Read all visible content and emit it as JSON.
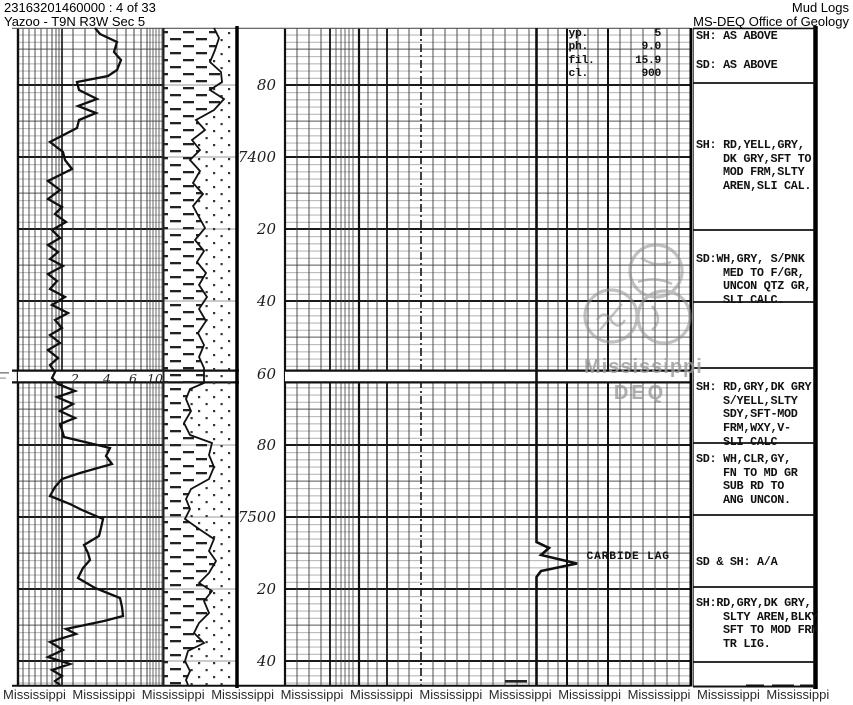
{
  "header": {
    "doc_id": "23163201460000 : 4 of 33",
    "location": "Yazoo - T9N R3W Sec 5",
    "title": "Mud Logs",
    "office": "MS-DEQ Office of Geology"
  },
  "depth_track": {
    "labels": [
      "80",
      "7400",
      "20",
      "40",
      "60",
      "80",
      "7500",
      "20",
      "40"
    ]
  },
  "rate_scale": [
    "2",
    "4",
    "6",
    "10"
  ],
  "mud_params": {
    "rows": [
      {
        "label": "yp.",
        "value": "5"
      },
      {
        "label": "ph.",
        "value": "9.0"
      },
      {
        "label": "fil.",
        "value": "15.9"
      },
      {
        "label": "cl.",
        "value": "900"
      }
    ]
  },
  "annotations": {
    "carbide": "CARBIDE LAG"
  },
  "descriptions": [
    {
      "lines": [
        "SH: AS ABOVE"
      ]
    },
    {
      "lines": [
        "SD: AS ABOVE"
      ]
    },
    {
      "lines": [
        "SH: RD,YELL,GRY,",
        "DK GRY,SFT TO",
        "MOD FRM,SLTY",
        "AREN,SLI CAL."
      ]
    },
    {
      "lines": [
        "SD:WH,GRY, S/PNK",
        "MED TO F/GR,",
        "UNCON QTZ GR,",
        "SLI CALC."
      ]
    },
    {
      "lines": [
        "SH: RD,GRY,DK GRY",
        "S/YELL,SLTY",
        "SDY,SFT-MOD",
        "FRM,WXY,V-",
        "SLI CALC"
      ]
    },
    {
      "lines": [
        "SD: WH,CLR,GY,",
        "FN TO MD GR",
        "SUB RD TO",
        "ANG UNCON."
      ]
    },
    {
      "lines": [
        "SD & SH: A/A"
      ]
    },
    {
      "lines": [
        "SH:RD,GRY,DK GRY,",
        "SLTY AREN,BLKY",
        "SFT TO MOD FRM",
        "TR LIG."
      ]
    }
  ],
  "watermark": {
    "logo_line1": "Mississippi",
    "logo_line2": "DEQ",
    "footer_word": "Mississippi",
    "footer_count": 12
  }
}
